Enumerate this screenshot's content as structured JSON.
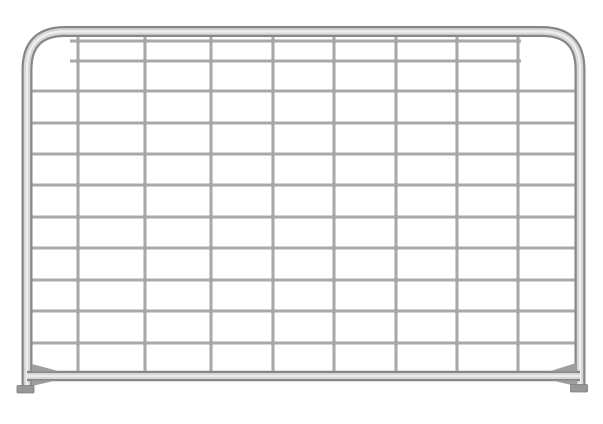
{
  "description": "Product photo of a galvanized steel mesh farm gate with tubular rounded-top frame on a white background",
  "canvas": {
    "width": 603,
    "height": 424,
    "background": "#ffffff"
  },
  "gate": {
    "colors": {
      "tube_edge": "#878787",
      "tube_core": "#d8d8d8",
      "tube_shine": "#f0f0f0",
      "wire_dark": "#8c8c8c",
      "wire_light": "#c6c6c6",
      "gusset": "#9e9e9e",
      "foot_fill": "#989898",
      "foot_edge": "#7c7c7c"
    },
    "frame": {
      "left_x": 27,
      "right_x": 580,
      "top_y": 31.5,
      "bottom_y": 391,
      "corner_radius": 38,
      "passes": [
        [
          "#878787",
          11
        ],
        [
          "#d8d8d8",
          6.5
        ],
        [
          "#f0f0f0",
          2
        ]
      ]
    },
    "bottom_rail": {
      "y": 376,
      "x1": 27,
      "x2": 580,
      "passes": [
        [
          "#878787",
          10.5
        ],
        [
          "#d8d8d8",
          6
        ],
        [
          "#eeeeee",
          1.8
        ]
      ]
    },
    "rail_gussets": [
      [
        [
          32,
          364
        ],
        [
          32,
          371.5
        ],
        [
          60,
          371.5
        ]
      ],
      [
        [
          32,
          380.5
        ],
        [
          32,
          386
        ],
        [
          56,
          380.5
        ]
      ],
      [
        [
          576,
          363
        ],
        [
          576,
          371.5
        ],
        [
          549,
          371.5
        ]
      ],
      [
        [
          576,
          380.5
        ],
        [
          576,
          386
        ],
        [
          552,
          380.5
        ]
      ]
    ],
    "feet": [
      {
        "x": 17,
        "y": 385.5,
        "w": 17,
        "h": 7.5
      },
      {
        "x": 570.5,
        "y": 384.5,
        "w": 17,
        "h": 7.5
      }
    ],
    "mesh": {
      "passes": [
        [
          "#8c8c8c",
          2.8
        ],
        [
          "#c6c6c6",
          1.0
        ]
      ],
      "verticals": {
        "xs": [
          78,
          145,
          211,
          273,
          334,
          396,
          457,
          518
        ],
        "y1": 33,
        "y2": 375.5
      },
      "horizontals_full": {
        "ys": [
          91,
          123,
          154,
          185,
          217,
          248,
          280,
          311,
          343
        ],
        "x1": 27,
        "x2": 580
      },
      "horizontals_short": {
        "ys": [
          41,
          61
        ],
        "x1": 70,
        "x2": 521
      }
    }
  }
}
